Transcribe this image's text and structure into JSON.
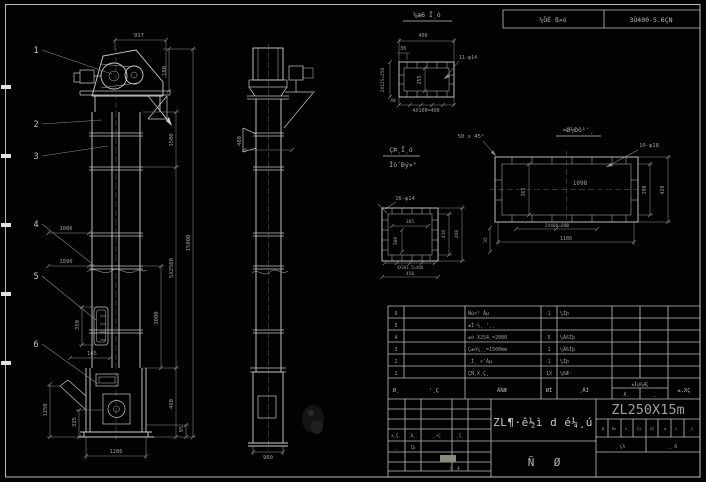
{
  "sheet": {
    "top_table": {
      "col1": "¼ÖÈ ß»ó",
      "col2": "3Ù400-5.6ÇN"
    }
  },
  "balloons": {
    "b1": "1",
    "b2": "2",
    "b3": "3",
    "b4": "4",
    "b5": "5",
    "b6": "6"
  },
  "front": {
    "d917": "917",
    "d180": "180",
    "d1500": "1500",
    "d5x2500": "5X2500",
    "d15000": "15000",
    "d3000": "3000",
    "d1086": "1086",
    "d1090": "1090",
    "d350": "350",
    "d165": "165",
    "d1250": "1250",
    "d325": "325",
    "d1286": "1286",
    "d460": "460",
    "d95": "95"
  },
  "side": {
    "d480": "480",
    "d960": "960"
  },
  "detail_a": {
    "title": "¼æ6 Ī¸ó",
    "d400": "400",
    "d30": "30",
    "holes": "11-φ14",
    "d255": "255",
    "dleft": "2X125=250",
    "d40": "40",
    "dbottom": "4X100=400"
  },
  "detail_b": {
    "title1": "ÇÞ¸Ī¸ó",
    "title2": "Īò´Ðý×°",
    "holes": "16-φ14",
    "d305": "305",
    "d300": "300",
    "d410": "410",
    "d460": "460",
    "dbottom1": "4X101.5=406",
    "dbottom2": "450",
    "d35": "35"
  },
  "detail_c": {
    "title": "¤Ø½Ðò¹'¸",
    "chamfer": "50 x 45°",
    "holes": "10-φ18",
    "d1098": "1098",
    "d365": "365",
    "d190": "190",
    "d420": "420",
    "dbottom1": "2X400=800",
    "dbottom2": "1180"
  },
  "bom": {
    "rows": [
      {
        "no": "6",
        "desc": "Ñù×° Äµ",
        "qty": "1",
        "mat": "¼Ìþ"
      },
      {
        "no": "5",
        "desc": "±Ì·½¸ '¸¸",
        "qty": "",
        "mat": ""
      },
      {
        "no": "4",
        "desc": "±ó X254¸=2000",
        "qty": "5",
        "mat": "¼Ä6Íþ"
      },
      {
        "no": "3",
        "desc": "Ç±ó¼¸¸=1500mm",
        "qty": "1",
        "mat": "¼Ä6Íþ"
      },
      {
        "no": "2",
        "desc": "¸Ì¸ ×'Äµ",
        "qty": "1",
        "mat": "¼Ìþ"
      },
      {
        "no": "1",
        "desc": "ÇÑ¸X¸Ç¸",
        "qty": "1X",
        "mat": "¼6Æ·"
      }
    ],
    "header": {
      "c1": "Ø¸",
      "c2": "'¸Ç",
      "c3": "ÄǸÆ",
      "c4": "ØÍ",
      "c5": "¸ÄÍ",
      "c6": "±Ì¼X¼ÆÇ",
      "c6a": "Ǽ¸",
      "c6b": "¸¸",
      "c7": "±,XÇ"
    }
  },
  "title_block": {
    "drawing_title": "ZL¶·ê½ì d é¼¸ú",
    "model": "ZL250X15m",
    "left_labels": [
      "±¸Ç¸",
      "¸Ð¸¸",
      "¸¸×Ç",
      "¸Ç¸"
    ],
    "left_row2": [
      "¸¸",
      "Íþ"
    ],
    "left_sign": "¸Ç ¸Æ¸",
    "mid_chars": [
      "Ñ",
      "Ø"
    ],
    "right_cells": [
      "¸Ð",
      "Ñt",
      "±¸",
      "Íý",
      "ÇÈ",
      "¸g",
      "±¸",
      "¸ý"
    ],
    "right_row2": [
      "¸ ÇÁ",
      "¸¸ Ǹ"
    ]
  }
}
